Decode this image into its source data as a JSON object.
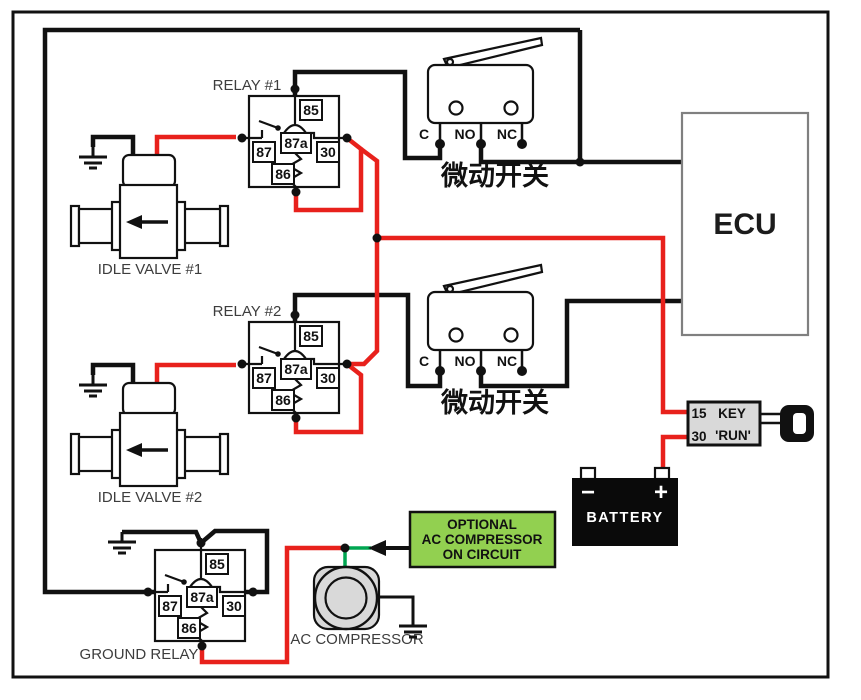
{
  "relays": {
    "relay1_label": "RELAY #1",
    "relay2_label": "RELAY #2",
    "ground_relay_label": "GROUND RELAY",
    "pins": {
      "p85": "85",
      "p87": "87",
      "p87a": "87a",
      "p30": "30",
      "p86": "86"
    }
  },
  "micro_switch": {
    "name": "微动开关",
    "terminal_c": "C",
    "terminal_no": "NO",
    "terminal_nc": "NC"
  },
  "idle_valve_1": "IDLE VALVE #1",
  "idle_valve_2": "IDLE VALVE #2",
  "ecu": "ECU",
  "key_switch": {
    "pin_15": "15",
    "pin_30": "30",
    "label_line1": "KEY",
    "label_line2": "'RUN'"
  },
  "battery": {
    "label": "BATTERY",
    "minus": "−",
    "plus": "+"
  },
  "ac_compressor": "AC COMPRESSOR",
  "optional_box": {
    "line1": "OPTIONAL",
    "line2": "AC COMPRESSOR",
    "line3": "ON CIRCUIT"
  },
  "colors": {
    "wire_black": "#111111",
    "wire_red": "#e8211c",
    "wire_green": "#00a651",
    "optional_box_fill": "#92d050",
    "component_gray": "#d9d9d9",
    "battery_black": "#0a0a0a",
    "ecu_border": "#808080"
  }
}
